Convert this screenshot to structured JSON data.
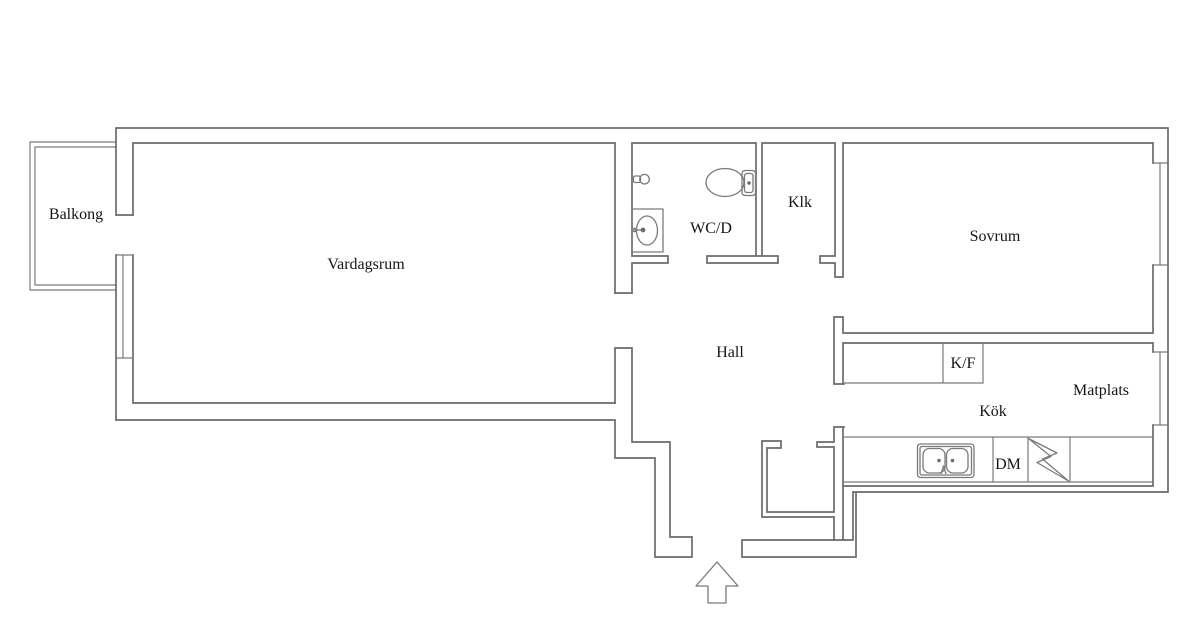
{
  "labels": {
    "balkong": "Balkong",
    "vardagsrum": "Vardagsrum",
    "wcd": "WC/D",
    "klk": "Klk",
    "sovrum": "Sovrum",
    "hall": "Hall",
    "kf": "K/F",
    "matplats": "Matplats",
    "kok": "Kök",
    "dm": "DM"
  },
  "colors": {
    "wall": "#6b6b6b",
    "thin": "#7a7a7a",
    "text": "#151515",
    "background": "#ffffff"
  },
  "fixtures": [
    "toilet-icon",
    "washbasin-icon",
    "shower-mixer-icon",
    "double-kitchen-sink-icon",
    "stove-bolt-icon",
    "entrance-arrow-icon",
    "window-icon",
    "balcony-railing-icon"
  ]
}
